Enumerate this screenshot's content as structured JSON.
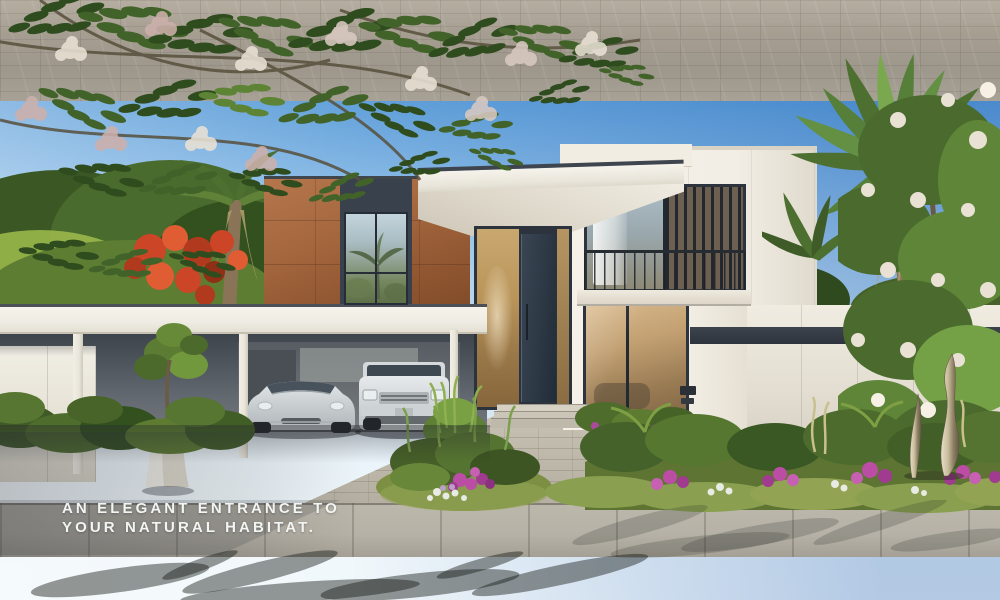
{
  "caption": {
    "line1": "AN ELEGANT ENTRANCE TO",
    "line2": "YOUR NATURAL HABITAT."
  },
  "scene": {
    "objects": [
      "modern-villa",
      "carport",
      "silver-sedan",
      "silver-suv",
      "date-palm",
      "flame-tree",
      "white-flowering-tree",
      "planter-pot",
      "garden-sculpture",
      "flower-beds",
      "paver-driveway",
      "sidewalk",
      "asphalt-road"
    ]
  },
  "palette": {
    "sky_top": "#3b82cd",
    "sky_mid": "#8dbde7",
    "sky_horizon": "#ecf6fb",
    "house_white": "#f2eee5",
    "house_shade": "#e0dacd",
    "terracotta_light": "#b5764c",
    "terracotta_dark": "#8e5530",
    "frame_dark": "#2d343d",
    "door_navy": "#2d3845",
    "glass_bronze_light": "#c2a072",
    "glass_bronze_dark": "#7e6544",
    "louver_glass": "#6d6050",
    "carport_shade": "#3d444c",
    "carport_wall": "#72777c",
    "paver_light": "#b6aea1",
    "paver_mid": "#9d978c",
    "sidewalk": "#b7b2a7",
    "road_light": "#4a4a48",
    "road_dark": "#2c2c2b",
    "foliage_dark": "#2f4c1e",
    "foliage_mid": "#4e6e30",
    "foliage_light": "#7fa03c",
    "blossom_white": "#e9e1d4",
    "blossom_mauve": "#cdb0ab",
    "flame_red": "#cc4527",
    "palm_green": "#4d7030",
    "palm_dry": "#ac9c6a",
    "trunk_brown": "#8a7458",
    "grass_green": "#7c8f42",
    "flower_magenta": "#bb4da4",
    "flower_white": "#e8eae4",
    "car_silver": "#c6cacc",
    "suv_silver": "#d0d4d6",
    "metal_light": "#e8e0c8",
    "metal_dark": "#7a6f58",
    "caption_color": "#f3f5f3"
  }
}
